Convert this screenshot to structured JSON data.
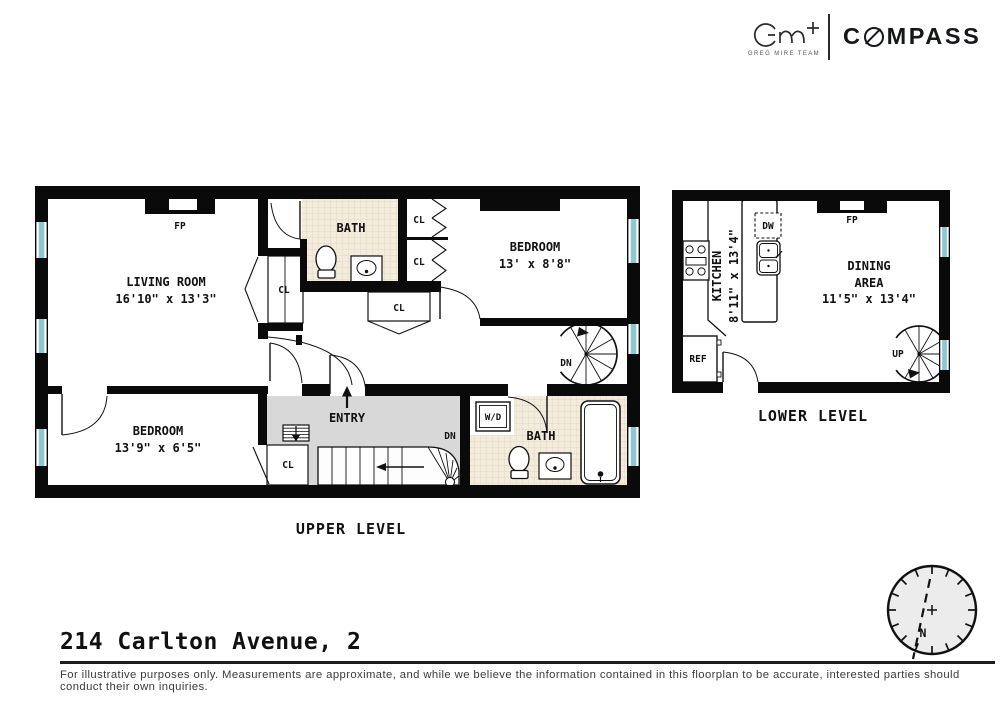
{
  "brand": {
    "team_monogram": "GM+",
    "team_name": "GREG MIRE TEAM",
    "company": "COMPASS",
    "company_prefix": "C",
    "company_suffix": "MPASS"
  },
  "upper_level": {
    "label": "UPPER LEVEL",
    "living_room": {
      "name": "LIVING ROOM",
      "dims": "16'10\" x 13'3\""
    },
    "bath_top": {
      "name": "BATH"
    },
    "bedroom_top": {
      "name": "BEDROOM",
      "dims": "13' x 8'8\""
    },
    "bedroom_bottom": {
      "name": "BEDROOM",
      "dims": "13'9\" x 6'5\""
    },
    "bath_bottom": {
      "name": "BATH"
    },
    "entry": {
      "name": "ENTRY"
    },
    "labels": {
      "fp": "FP",
      "cl": "CL",
      "dn": "DN",
      "wd": "W/D"
    }
  },
  "lower_level": {
    "label": "LOWER LEVEL",
    "kitchen": {
      "name": "KITCHEN",
      "dims": "8'11\" x 13'4\""
    },
    "dining": {
      "line1": "DINING",
      "line2": "AREA",
      "dims": "11'5\" x 13'4\""
    },
    "labels": {
      "fp": "FP",
      "dw": "DW",
      "ref": "REF",
      "up": "UP"
    }
  },
  "compass_rose": {
    "north": "N"
  },
  "footer": {
    "address": "214 Carlton Avenue, 2",
    "disclaimer": "For illustrative purposes only.  Measurements are approximate, and while we believe the information contained in this floorplan to be accurate, interested parties should conduct their own inquiries."
  },
  "colors": {
    "wall": "#0a0a0a",
    "window": "#8ec7d1",
    "tile": "#f3ecdc",
    "tile_line": "#ddd3bb",
    "entry_floor": "#d8d8d8",
    "brand_dark": "#16171b"
  }
}
